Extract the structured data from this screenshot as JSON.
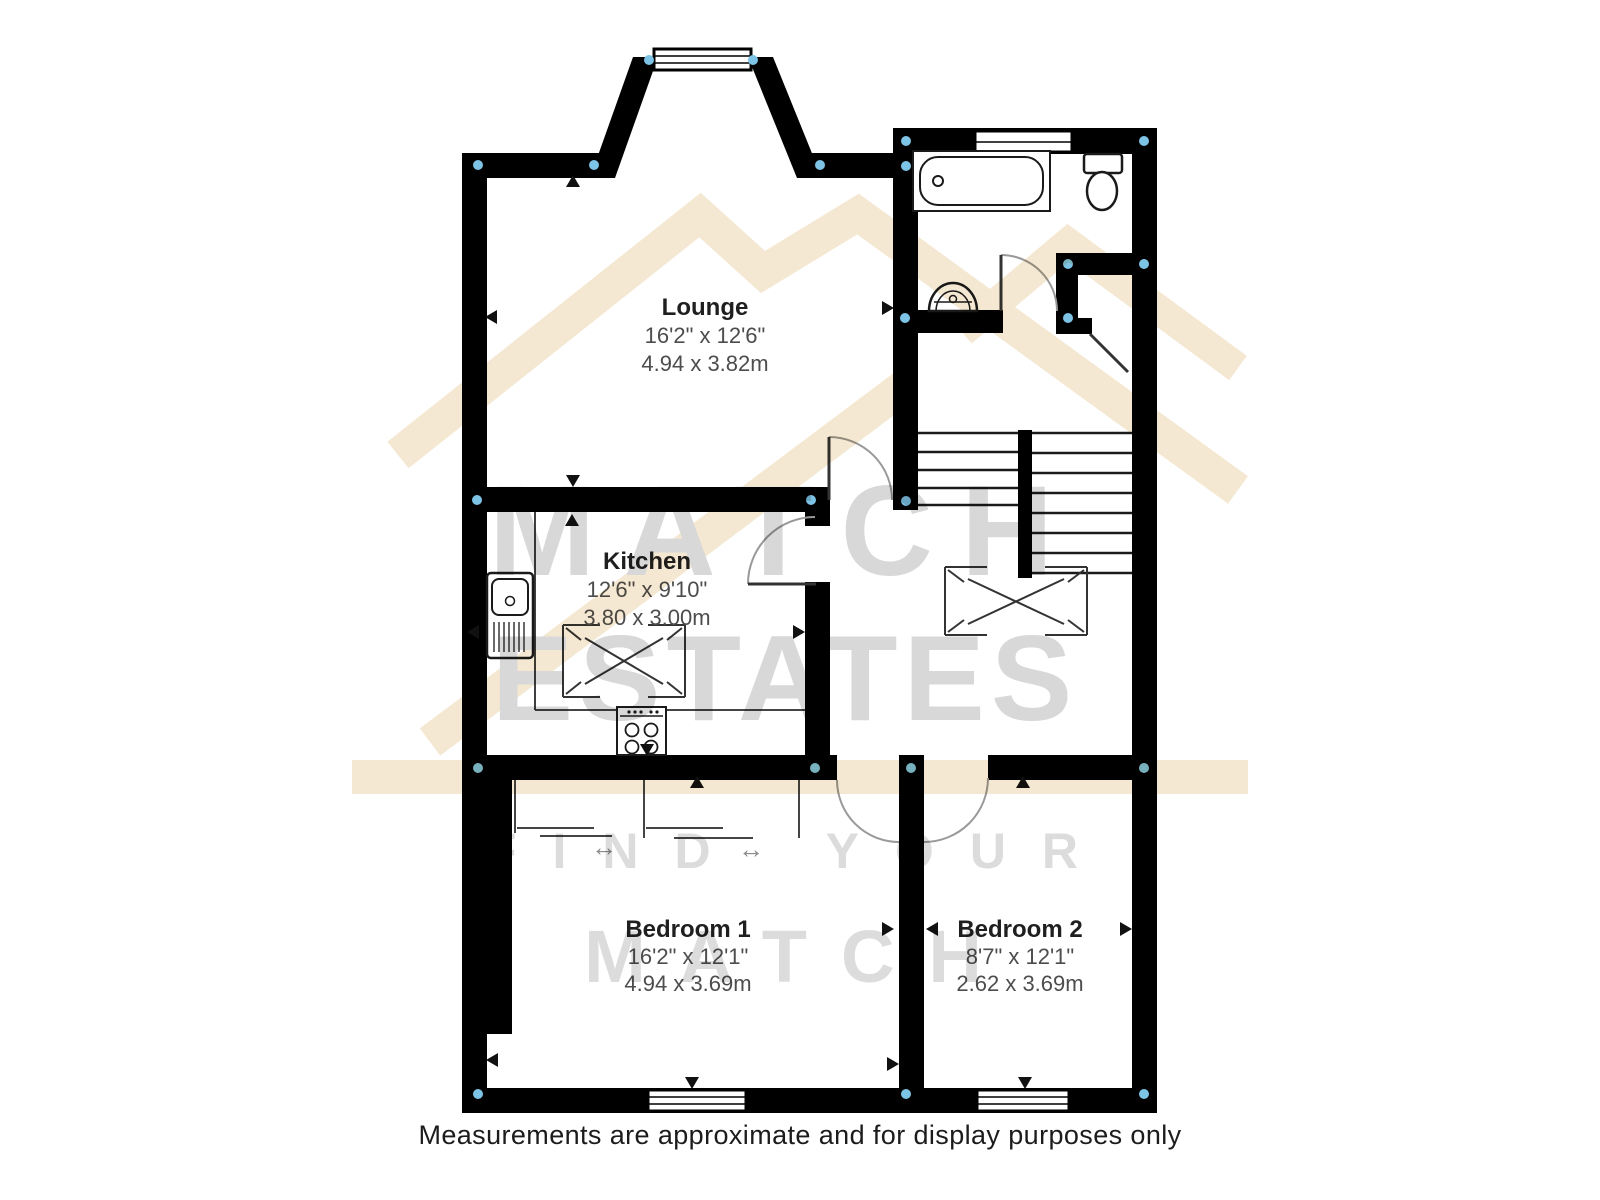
{
  "watermark": {
    "brand_top": "MATCH",
    "brand_bottom": "ESTATES",
    "tagline_line1": "FIND YOUR",
    "tagline_line2": "MATCH"
  },
  "rooms": {
    "lounge": {
      "name": "Lounge",
      "imperial": "16'2\" x 12'6\"",
      "metric": "4.94 x 3.82m"
    },
    "kitchen": {
      "name": "Kitchen",
      "imperial": "12'6\" x 9'10\"",
      "metric": "3.80 x 3.00m"
    },
    "bedroom1": {
      "name": "Bedroom 1",
      "imperial": "16'2\" x 12'1\"",
      "metric": "4.94 x 3.69m"
    },
    "bedroom2": {
      "name": "Bedroom 2",
      "imperial": "8'7\" x 12'1\"",
      "metric": "2.62 x 3.69m"
    }
  },
  "icons": {
    "slide_arrow": "↔"
  },
  "caption": "Measurements are approximate and for display purposes only",
  "colors": {
    "wall": "#000000",
    "corner_dot": "#7cc3e6",
    "watermark_tan": "#f5e8d2",
    "watermark_gray": "#d8d8d8",
    "dimension_text": "#4d4d4d"
  }
}
